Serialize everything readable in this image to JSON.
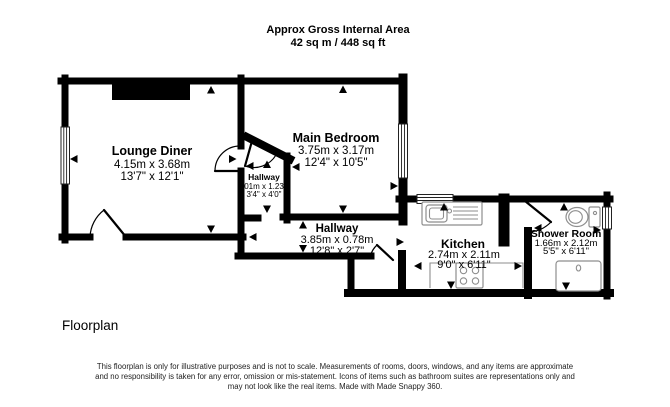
{
  "title": {
    "line1": "Approx Gross Internal Area",
    "line2": "42 sq m / 448 sq ft"
  },
  "rooms": {
    "lounge": {
      "name": "Lounge Diner",
      "metric": "4.15m x 3.68m",
      "imperial": "13'7\" x 12'1\""
    },
    "bedroom": {
      "name": "Main Bedroom",
      "metric": "3.75m x 3.17m",
      "imperial": "12'4\" x 10'5\""
    },
    "hallway_small": {
      "name": "Hallway",
      "metric": "1.01m x 1.23m",
      "imperial": "3'4\" x 4'0\""
    },
    "hallway": {
      "name": "Hallway",
      "metric": "3.85m x 0.78m",
      "imperial": "12'8\" x 2'7\""
    },
    "kitchen": {
      "name": "Kitchen",
      "metric": "2.74m x 2.11m",
      "imperial": "9'0\" x 6'11\""
    },
    "shower_room": {
      "name": "Shower Room",
      "metric": "1.66m x 2.12m",
      "imperial": "5'5\" x 6'11\""
    }
  },
  "footer": {
    "label": "Floorplan"
  },
  "disclaimer": {
    "line1": "This floorplan is only for illustrative purposes and is not to scale. Measurements of rooms, doors, windows, and any items are approximate",
    "line2": "and no responsibility is taken for any error, omission or mis-statement. Icons of items such as bathroom suites are representations only and",
    "line3": "may not look like the real items. Made with Made Snappy 360."
  },
  "icons": {
    "fixtures": [
      "kitchen-sink-icon",
      "hob-icon",
      "toilet-icon",
      "shower-tray-icon",
      "window-icon",
      "door-arc-icon",
      "measure-arrow-icon"
    ]
  },
  "colors": {
    "walls": "#000000",
    "background": "#ffffff",
    "fixtures": "#8e8e8e",
    "text": "#000000"
  }
}
